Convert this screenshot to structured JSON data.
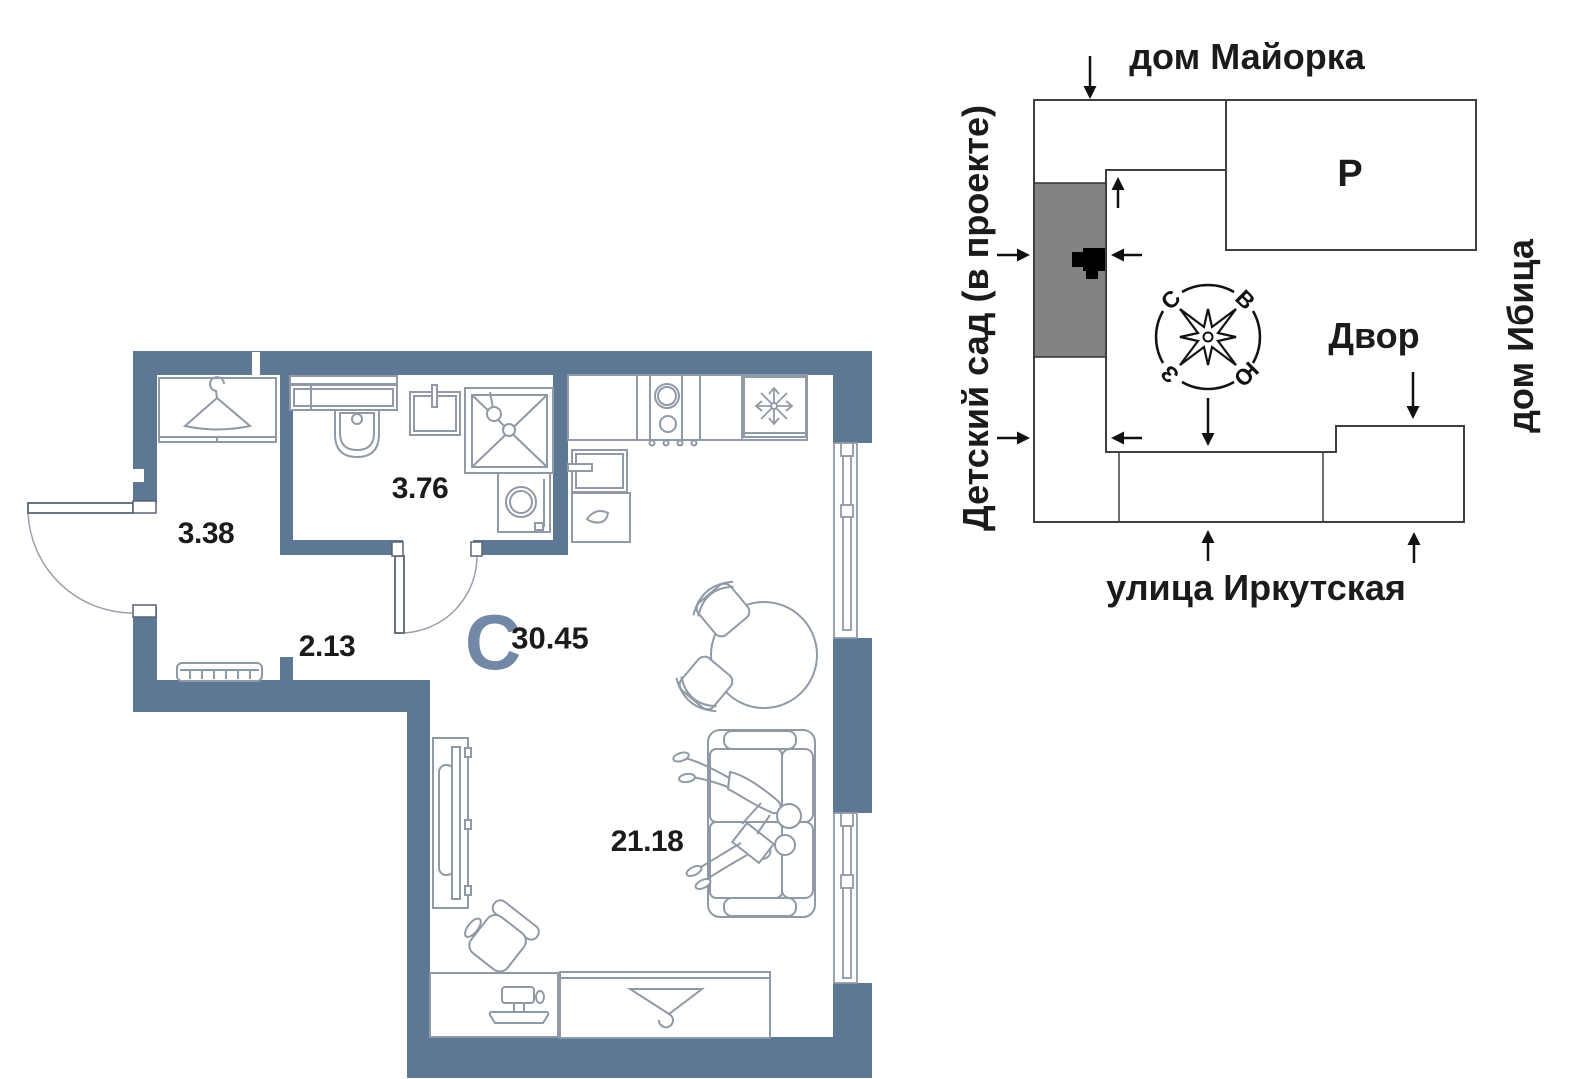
{
  "floor_plan": {
    "studio_letter": "С",
    "total_area": "30.45",
    "rooms": {
      "hallway_area": "3.38",
      "bathroom_area": "3.76",
      "corridor_area": "2.13",
      "living_kitchen_area": "21.18"
    }
  },
  "site_plan": {
    "top_label": "дом Майорка",
    "right_label": "дом Ибица",
    "left_label": "Детский сад (в проекте)",
    "bottom_label": "улица Иркутская",
    "courtyard_label": "Двор",
    "parking_label": "Р",
    "compass": {
      "north": "С",
      "east": "В",
      "south": "Ю",
      "west": "З"
    }
  },
  "colors": {
    "wall": "#5e7794",
    "studio_letter": "#7288a6",
    "site_block_gray": "#838383",
    "furniture_line": "#9099a6",
    "text": "#1b1b1b"
  }
}
